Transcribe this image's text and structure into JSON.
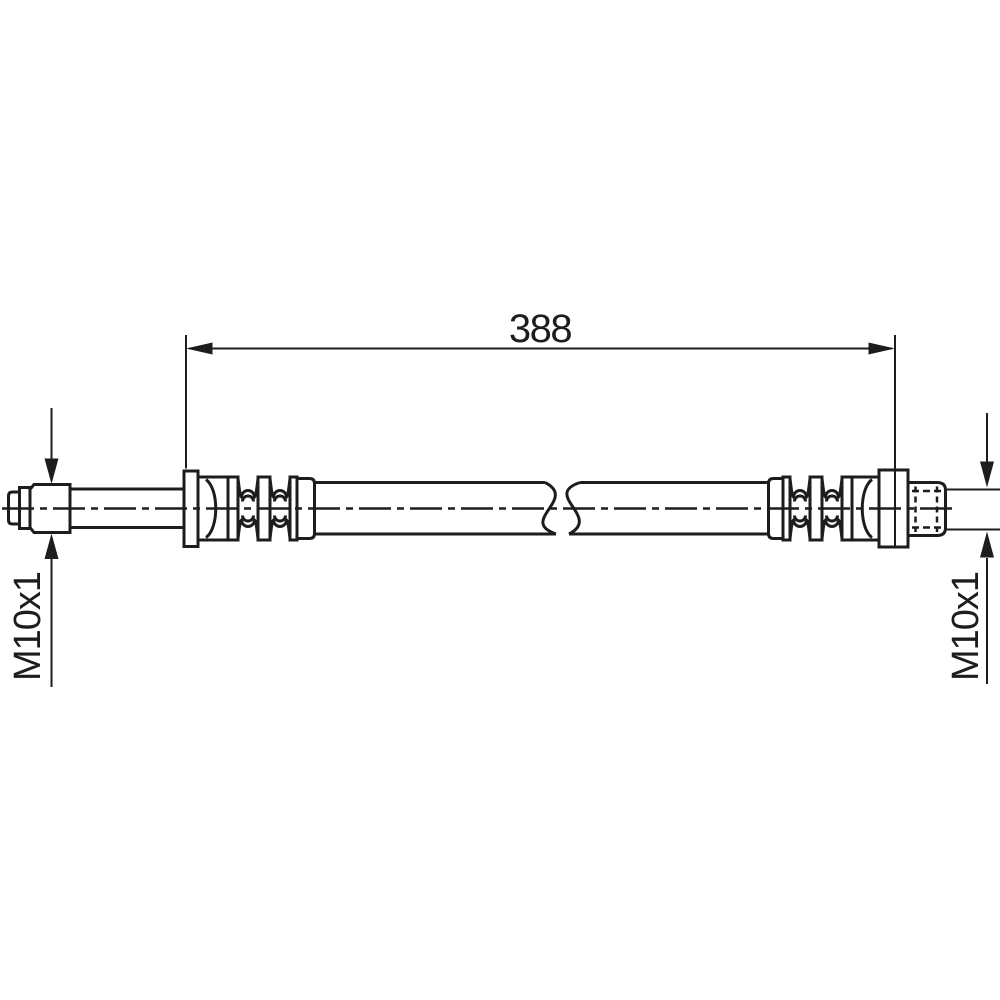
{
  "drawing": {
    "overall_length": "388",
    "left_thread_label": "M10x1",
    "right_thread_label": "M10x1",
    "colors": {
      "line": "#1d1d1b",
      "background": "#ffffff"
    }
  }
}
